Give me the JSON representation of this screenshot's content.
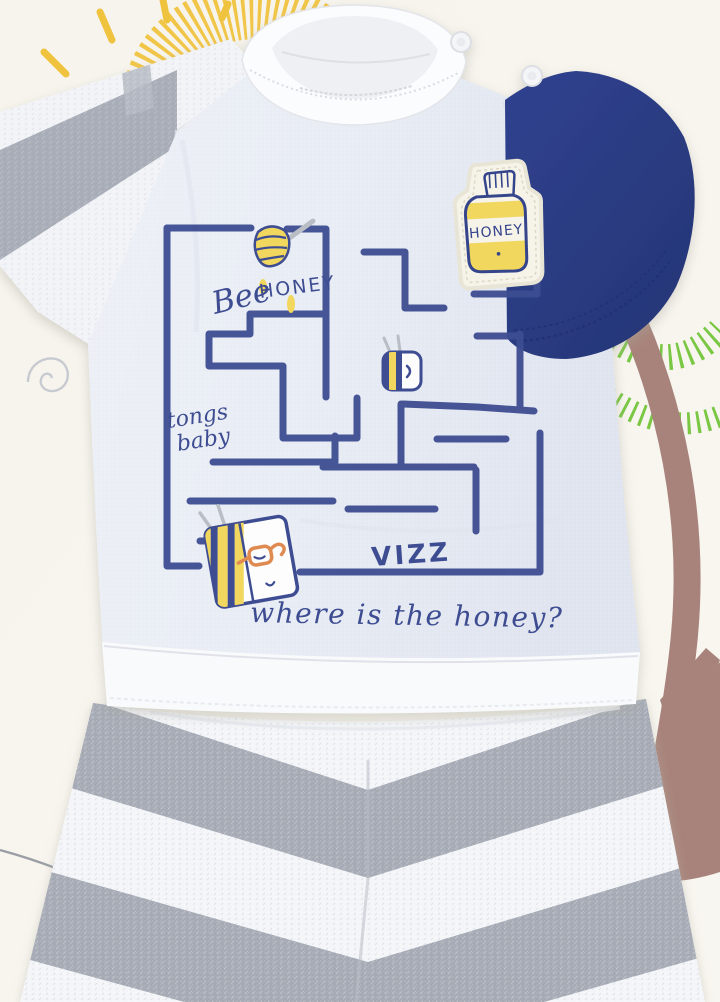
{
  "photo": {
    "tshirt_print": {
      "bee_script": "Bee",
      "honey_word": "HONEY",
      "tongs_line1": "tongs",
      "tongs_line2": "baby",
      "vizz": "VIZZ",
      "question": "where is the honey?"
    },
    "patch": {
      "label": "HONEY"
    },
    "colors": {
      "print_navy": "#3e4d92",
      "sleeve_navy": "#2c3e8e",
      "honey_yellow": "#f1d75e",
      "sun_yellow": "#f0c33f",
      "leaf_green": "#6fc235",
      "trunk_brown": "#a8837b",
      "heather_gray": "#a6abb5",
      "shirt_body": "#e8ecf4",
      "background_cream": "#f7f5ee"
    },
    "icons": [
      "sun-doodle-icon",
      "spiral-doodle-icon",
      "foliage-scribble-icon",
      "tree-trunk-doodle-icon",
      "honey-dipper-icon",
      "bee-icon",
      "beehive-book-icon",
      "honey-jar-patch-icon",
      "snap-button"
    ]
  }
}
